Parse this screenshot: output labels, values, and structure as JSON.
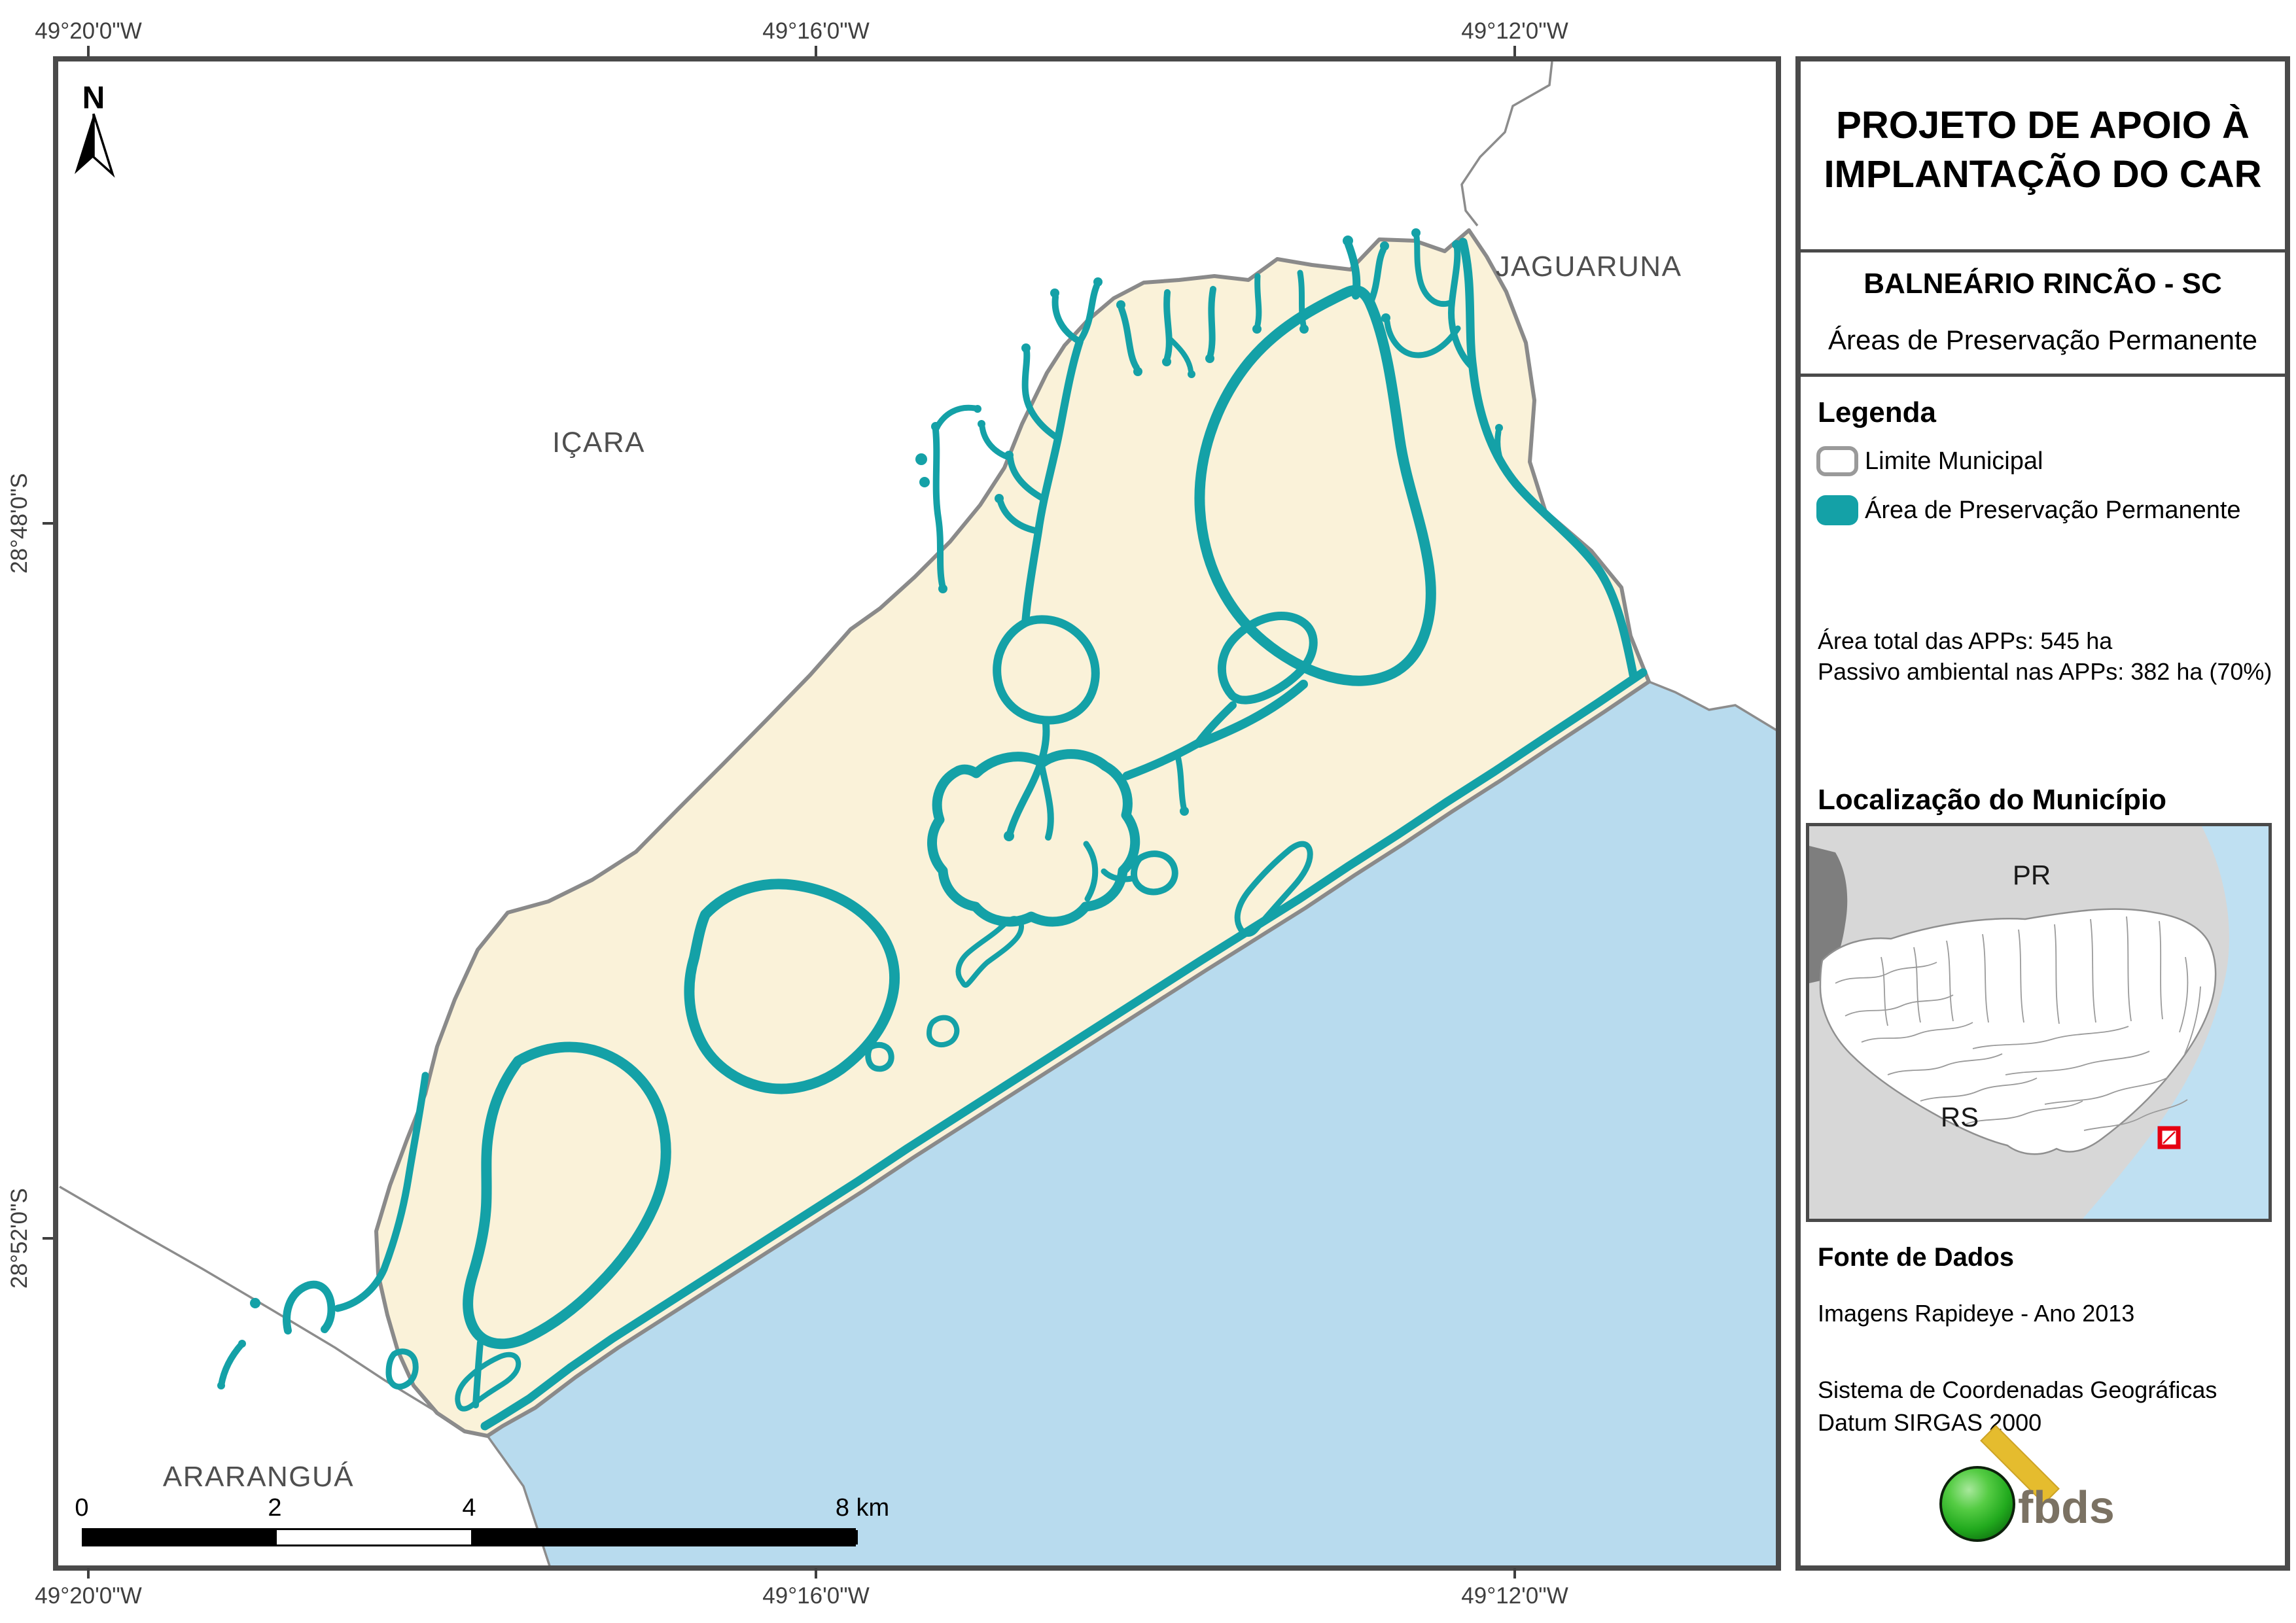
{
  "page_title": "Projeto de Apoio à Implantação do CAR — Balneário Rincão - SC",
  "colors": {
    "app_teal": "#14A1A7",
    "municipality_fill": "#FAF2D9",
    "ocean_blue": "#B8DBEE",
    "boundary_gray": "#8A8A8A",
    "frame_gray": "#4A4A4A",
    "inset_background": "#D7D7D7",
    "inset_ocean": "#BFE0F2",
    "highlight_red": "#E60012",
    "logo_green": "#2DB52D",
    "logo_yellow": "#E5BC2E",
    "logo_text_gray": "#7B7263"
  },
  "map": {
    "north_label": "N",
    "neighbors": {
      "north": "JAGUARUNA",
      "west": "IÇARA",
      "southwest": "ARARANGUÁ"
    },
    "coordinates": {
      "top": [
        "49°20'0\"W",
        "49°16'0\"W",
        "49°12'0\"W"
      ],
      "bottom": [
        "49°20'0\"W",
        "49°16'0\"W",
        "49°12'0\"W"
      ],
      "left": [
        "28°48'0\"S",
        "28°52'0\"S"
      ]
    },
    "scale_bar": {
      "tick0": "0",
      "tick2": "2",
      "tick4": "4",
      "tick8": "8 km"
    }
  },
  "panel": {
    "title_line1": "PROJETO DE APOIO À",
    "title_line2": "IMPLANTAÇÃO DO CAR",
    "municipality": "BALNEÁRIO RINCÃO - SC",
    "subtitle": "Áreas de Preservação Permanente",
    "legend": {
      "heading": "Legenda",
      "items": [
        {
          "label": "Limite Municipal"
        },
        {
          "label": "Área de Preservação Permanente"
        }
      ]
    },
    "stats_line1": "Área total das APPs: 545 ha",
    "stats_line2": "Passivo ambiental nas APPs: 382 ha (70%)",
    "inset": {
      "heading": "Localização do Município",
      "state_north": "PR",
      "state_south": "RS"
    },
    "source": {
      "heading": "Fonte de Dados",
      "line1": "Imagens Rapideye - Ano 2013",
      "line2": "Sistema de Coordenadas Geográficas",
      "line3": "Datum SIRGAS 2000"
    },
    "logo_text": "fbds"
  }
}
